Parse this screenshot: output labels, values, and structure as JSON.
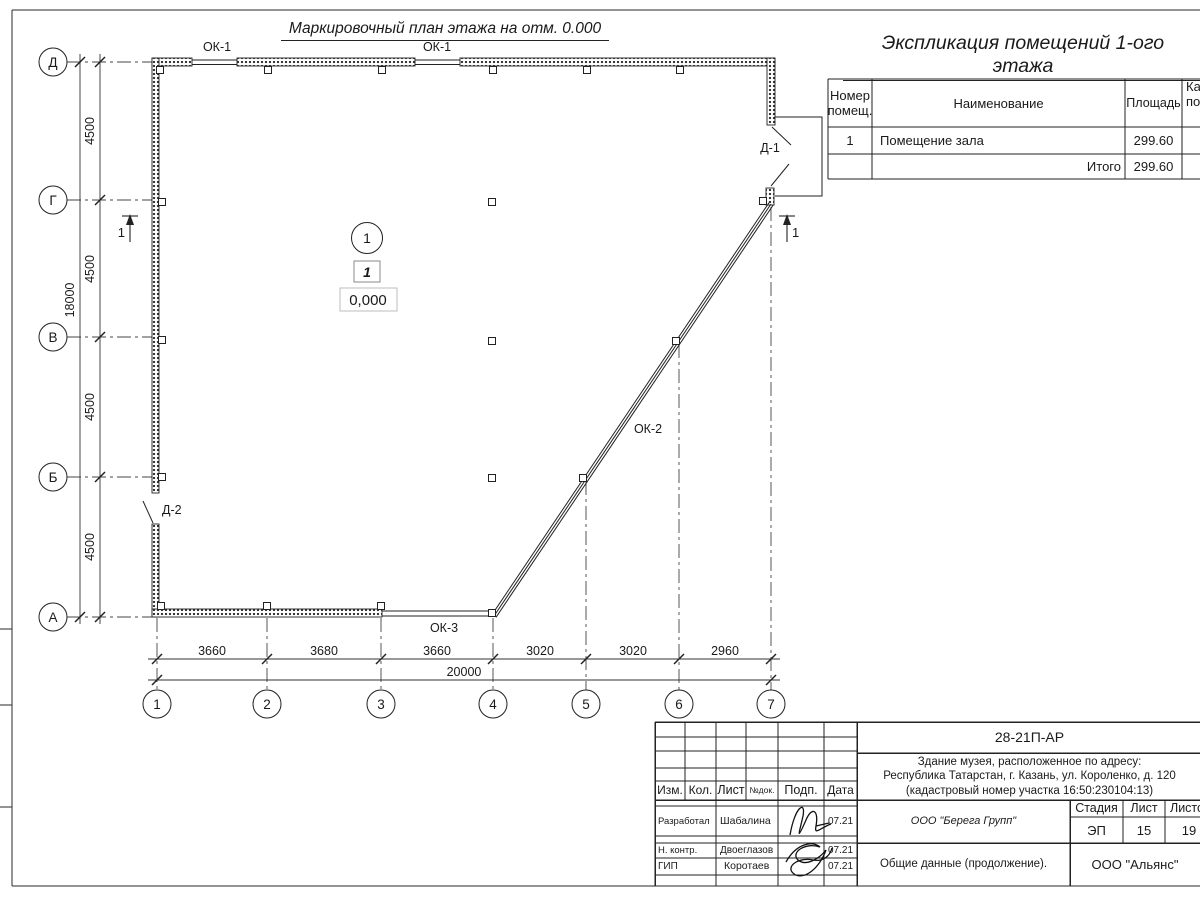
{
  "sheet": {
    "plan_title": "Маркировочный план этажа на отм. 0.000"
  },
  "expl": {
    "heading": "Экспликация помещений 1-ого этажа",
    "col_num_line1": "Номер",
    "col_num_line2": "помещ.",
    "col_name": "Наименование",
    "col_area": "Площадь",
    "col_cat_line1": "Ка",
    "col_cat_line2": "по",
    "rows": [
      {
        "num": "1",
        "name": "Помещение зала",
        "area": "299.60"
      }
    ],
    "total_label": "Итого",
    "total_area": "299.60"
  },
  "plan": {
    "axis_rows": [
      "Д",
      "Г",
      "В",
      "Б",
      "А"
    ],
    "axis_cols": [
      "1",
      "2",
      "3",
      "4",
      "5",
      "6",
      "7"
    ],
    "dims_left": [
      "4500",
      "4500",
      "4500",
      "4500"
    ],
    "dim_left_total": "18000",
    "dims_bottom": [
      "3660",
      "3680",
      "3660",
      "3020",
      "3020",
      "2960"
    ],
    "dim_bottom_total": "20000",
    "labels": {
      "ok1_left": "ОК-1",
      "ok1_right": "ОК-1",
      "ok2": "ОК-2",
      "ok3": "ОК-3",
      "door1": "Д-1",
      "door2": "Д-2"
    },
    "section_mark": "1",
    "room": {
      "number": "1",
      "tag": "1",
      "elevation": "0,000"
    }
  },
  "titleblock": {
    "doc_number": "28-21П-АР",
    "project_line1": "Здание музея, расположенное по адресу:",
    "project_line2": "Республика Татарстан, г. Казань, ул. Короленко, д. 120",
    "project_line3": "(кадастровый номер участка 16:50:230104:13)",
    "cols": [
      "Изм.",
      "Кол.",
      "Лист",
      "№док.",
      "Подп.",
      "Дата"
    ],
    "rows": [
      {
        "role": "Разработал",
        "name": "Шабалина",
        "date": "07.21"
      },
      {
        "role": "Н. контр.",
        "name": "Двоеглазов",
        "date": "07.21"
      },
      {
        "role": "ГИП",
        "name": "Коротаев",
        "date": "07.21"
      }
    ],
    "org1": "ООО \"Берега Групп\"",
    "stage_label": "Стадия",
    "sheet_label": "Лист",
    "sheets_label": "Листов",
    "stage": "ЭП",
    "sheet": "15",
    "sheets": "19",
    "doc_title": "Общие данные (продолжение).",
    "org2": "ООО \"Альянс\""
  }
}
